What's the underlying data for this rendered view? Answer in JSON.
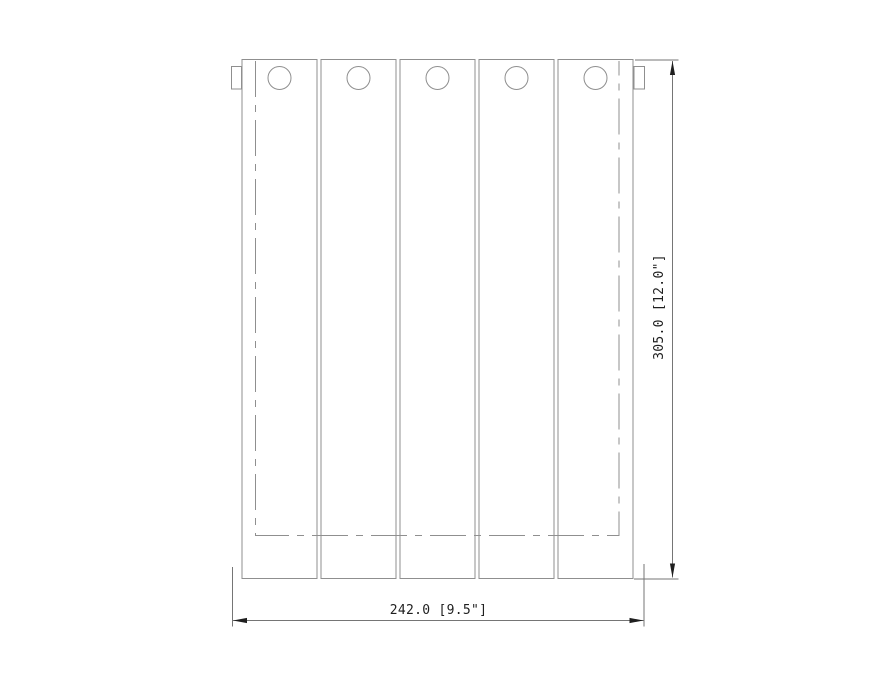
{
  "drawing": {
    "kind": "technical-drawing-front-view",
    "panels": {
      "count": 5,
      "holes_per_panel": 1
    },
    "dimensions": {
      "width": {
        "label": "242.0 [9.5\"]",
        "mm": 242.0,
        "inches": 9.5
      },
      "height": {
        "label": "305.0 [12.0\"]",
        "mm": 305.0,
        "inches": 12.0
      }
    },
    "colors": {
      "background": "#ffffff",
      "geometry": "#8f8f8f",
      "dimension_lines": "#757575",
      "dimension_text": "#1f1f1f"
    }
  }
}
